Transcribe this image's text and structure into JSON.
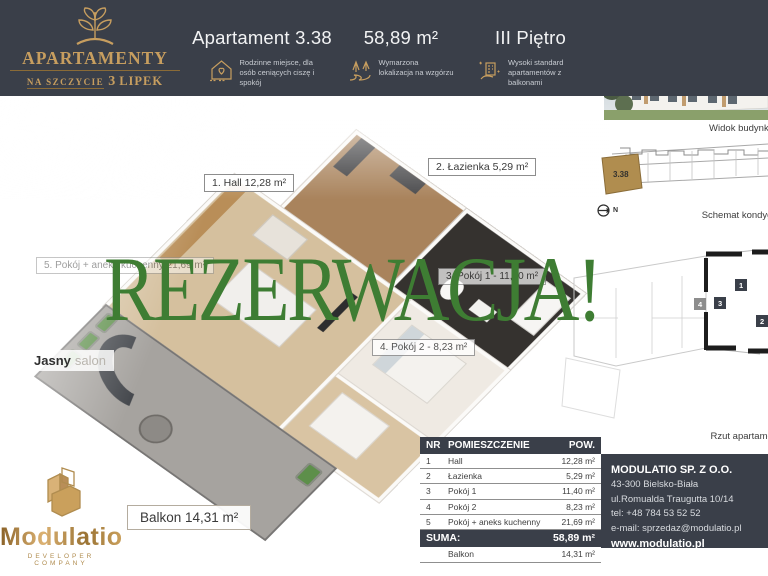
{
  "colors": {
    "header_bg": "#3a3f49",
    "accent_gold": "#c79e5f",
    "reservation_green": "#3e7d33",
    "table_dark": "#3a3f49",
    "schematic_unit_gold": "#b08d4f"
  },
  "brand": {
    "title": "APARTAMENTY",
    "subtitle_small": "NA SZCZYCIE",
    "subtitle_num": "3",
    "subtitle_rest": "LIPEK",
    "icon": "tree-leaves-icon"
  },
  "header": {
    "apartment_title": "Apartament 3.38",
    "area": "58,89 m²",
    "floor": "III Piętro",
    "features": [
      {
        "icon": "family-house-heart-icon",
        "text": "Rodzinne miejsce, dla osób ceniących ciszę i spokój"
      },
      {
        "icon": "hillside-trees-icon",
        "text": "Wymarzona lokalizacja na wzgórzu"
      },
      {
        "icon": "hand-building-icon",
        "text": "Wysoki standard apartamentów z balkonami"
      }
    ]
  },
  "overlay": {
    "reservation_text": "REZERWACJA!"
  },
  "floorplan_labels": {
    "hall": "1. Hall 12,28 m²",
    "lazienka": "2. Łazienka 5,29 m²",
    "pokoj_aneks": "5. Pokój + aneks kuchenny 21,69 m²",
    "pokoj1": "3. Pokój 1 - 11,40 m²",
    "pokoj2": "4. Pokój 2 - 8,23 m²",
    "salon_word1": "Jasny",
    "salon_word2": "salon",
    "balkon": "Balkon 14,31 m²"
  },
  "sidebar": {
    "building_caption": "Widok budynku",
    "schematic_caption": "Schemat kondygnacji",
    "plan_caption": "Rzut apartamentu",
    "schematic_unit": "3.38",
    "north_label": "N",
    "plan_markers": [
      "1",
      "2",
      "3",
      "4"
    ]
  },
  "table": {
    "headers": [
      "NR",
      "POMIESZCZENIE",
      "POW."
    ],
    "rows": [
      {
        "nr": "1",
        "name": "Hall",
        "area": "12,28 m²"
      },
      {
        "nr": "2",
        "name": "Łazienka",
        "area": "5,29 m²"
      },
      {
        "nr": "3",
        "name": "Pokój 1",
        "area": "11,40 m²"
      },
      {
        "nr": "4",
        "name": "Pokój 2",
        "area": "8,23 m²"
      },
      {
        "nr": "5",
        "name": "Pokój + aneks kuchenny",
        "area": "21,69 m²"
      }
    ],
    "suma_label": "SUMA:",
    "suma_value": "58,89 m²",
    "balkon_label": "Balkon",
    "balkon_value": "14,31 m²"
  },
  "contact": {
    "company": "MODULATIO SP. Z O.O.",
    "address_line1": "43-300 Bielsko-Biała",
    "address_line2": "ul.Romualda Traugutta 10/14",
    "phone": "tel: +48 784 53 52 52",
    "email": "e-mail: sprzedaz@modulatio.pl",
    "website": "www.modulatio.pl"
  },
  "developer": {
    "name": "Modulatio",
    "tagline": "DEVELOPER COMPANY",
    "icon": "building-blocks-icon"
  }
}
